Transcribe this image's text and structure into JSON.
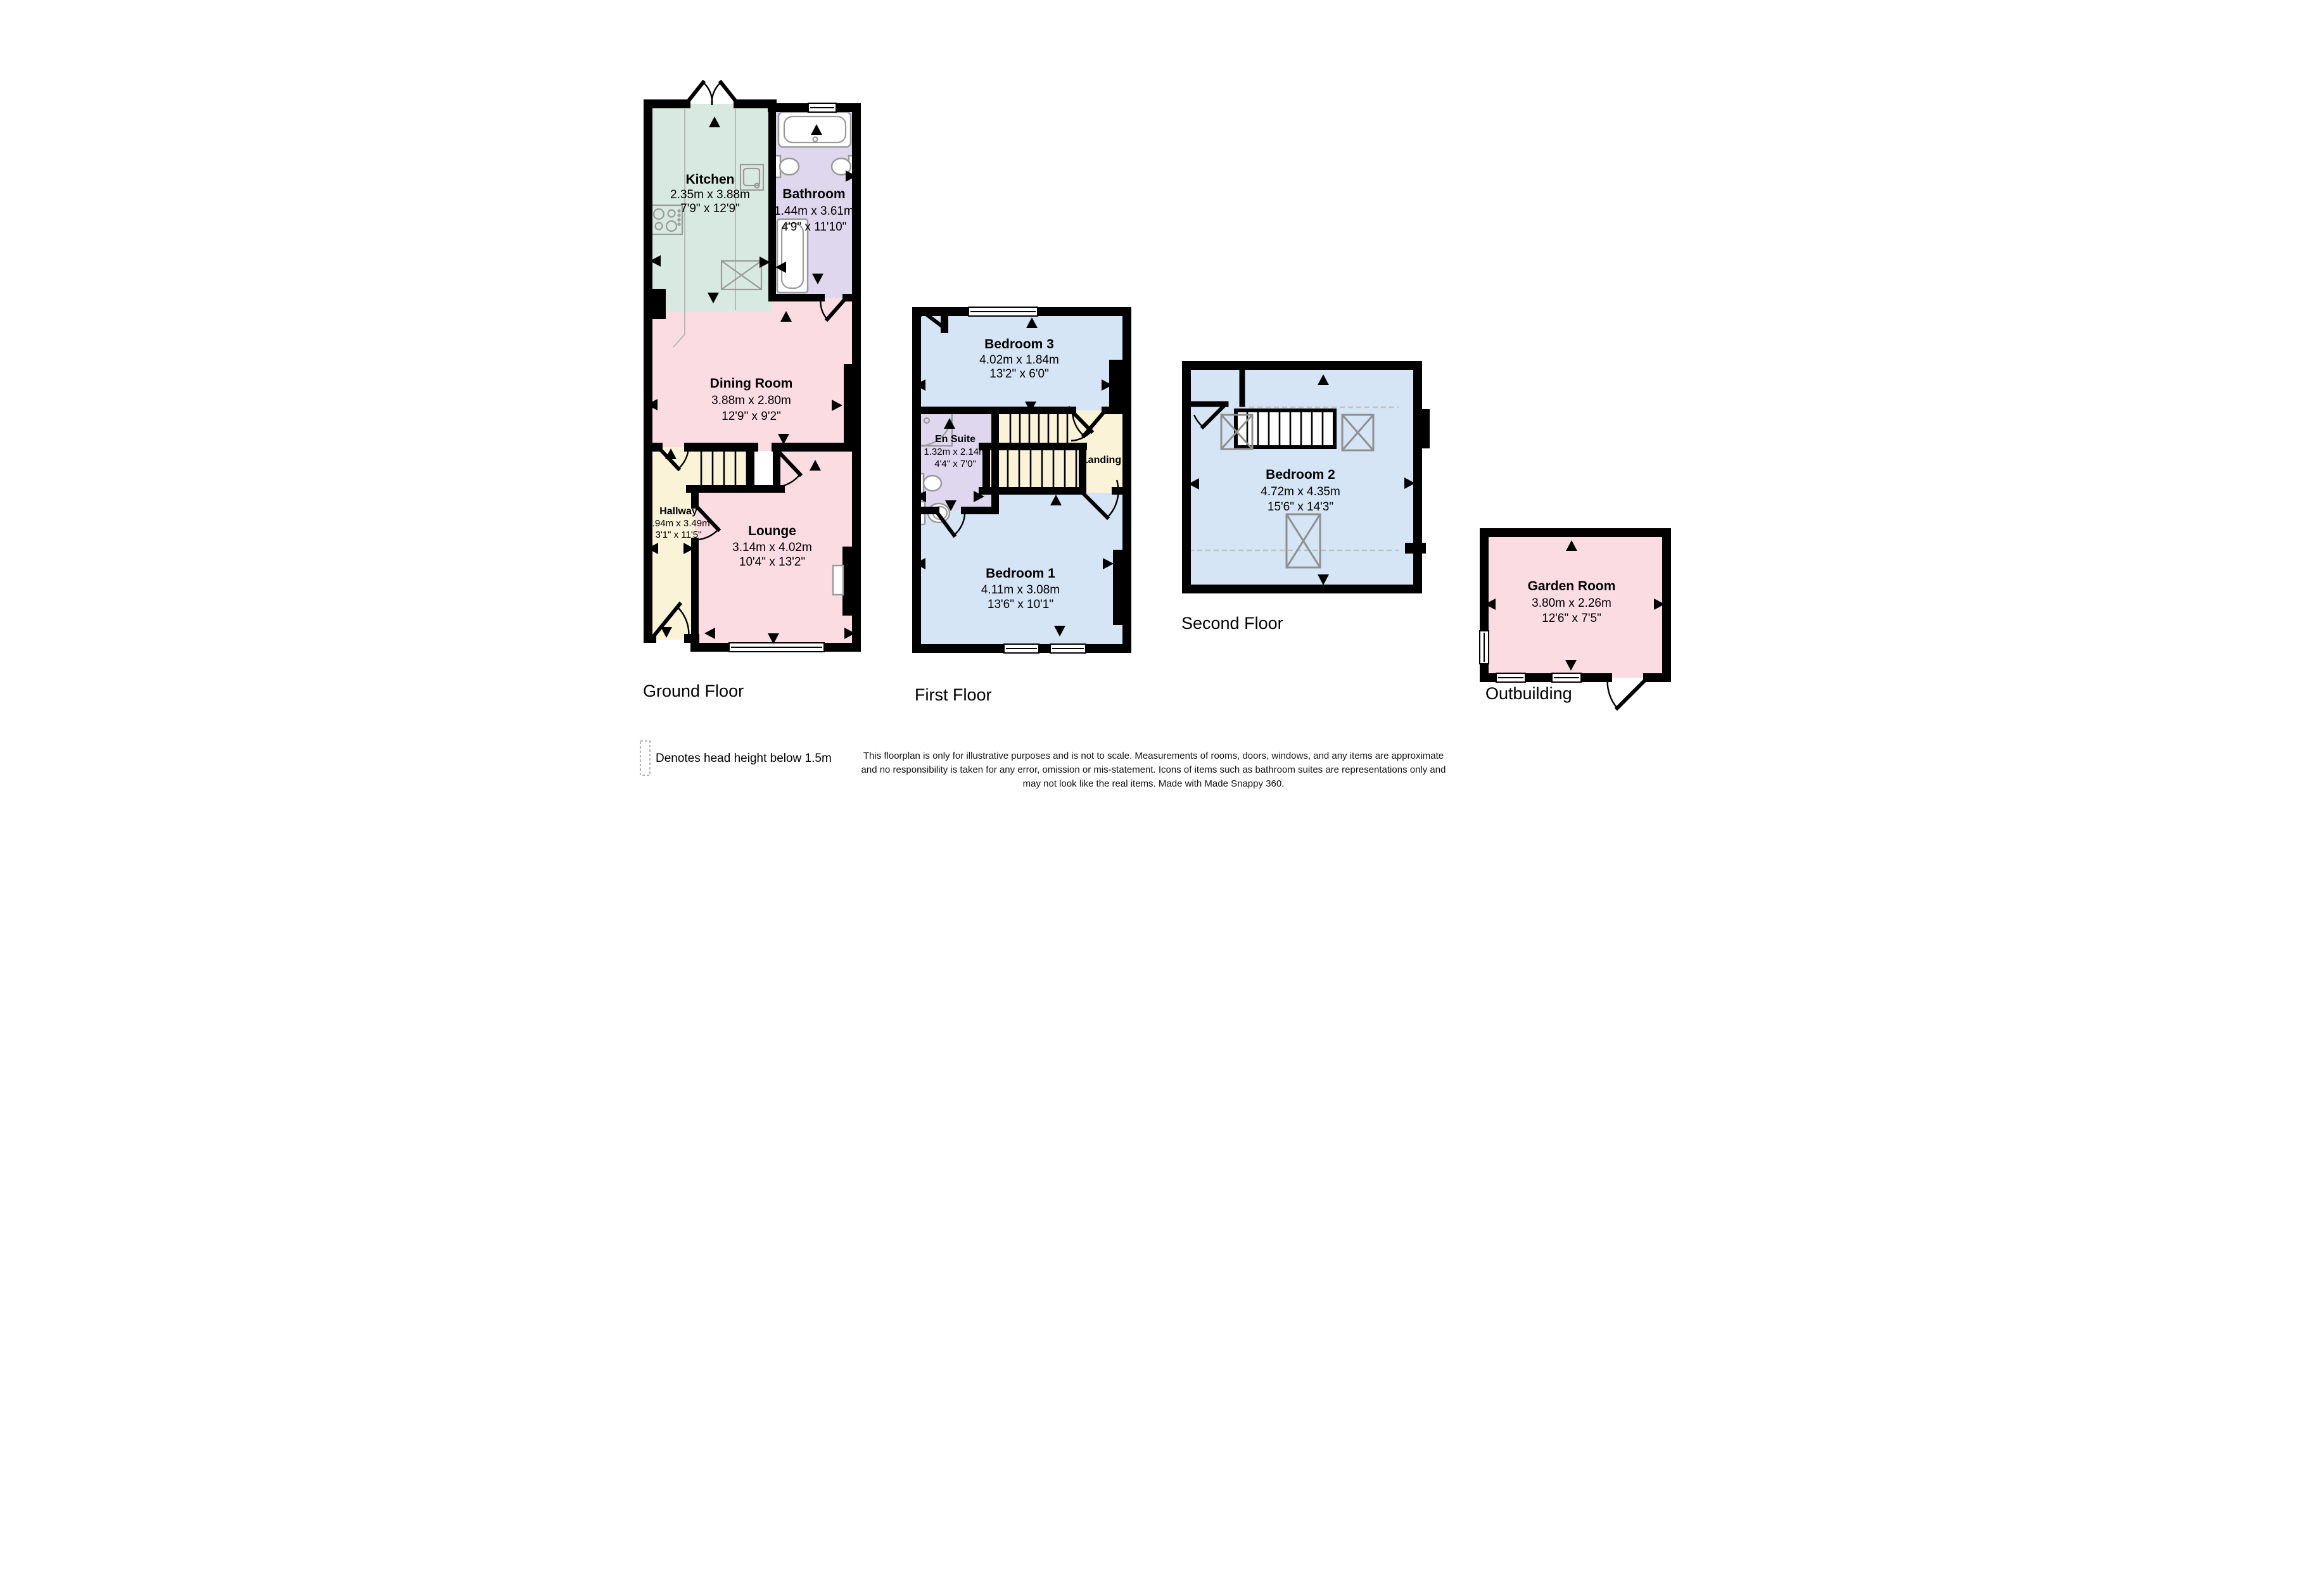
{
  "colors": {
    "wall": "#000000",
    "room_kitchen": "#d8e9e1",
    "room_bath": "#ded7ee",
    "room_pink": "#fbdce2",
    "room_cream": "#fbf3d8",
    "room_blue": "#d5e5f6",
    "fixture_outline": "#9a9a9a",
    "head_height_dash": "#c2c2c2"
  },
  "floors": {
    "ground": {
      "label": "Ground Floor",
      "rooms": {
        "kitchen": {
          "name": "Kitchen",
          "metric": "2.35m x 3.88m",
          "imperial": "7'9\" x 12'9\""
        },
        "bathroom": {
          "name": "Bathroom",
          "metric": "1.44m x 3.61m",
          "imperial": "4'9\" x 11'10\""
        },
        "dining": {
          "name": "Dining Room",
          "metric": "3.88m x 2.80m",
          "imperial": "12'9\" x 9'2\""
        },
        "hallway": {
          "name": "Hallway",
          "metric": "0.94m x 3.49m",
          "imperial": "3'1\" x 11'5\""
        },
        "lounge": {
          "name": "Lounge",
          "metric": "3.14m x 4.02m",
          "imperial": "10'4\" x 13'2\""
        }
      }
    },
    "first": {
      "label": "First Floor",
      "rooms": {
        "bedroom3": {
          "name": "Bedroom 3",
          "metric": "4.02m x 1.84m",
          "imperial": "13'2\" x 6'0\""
        },
        "ensuite": {
          "name": "En Suite",
          "metric": "1.32m x 2.14m",
          "imperial": "4'4\" x 7'0\""
        },
        "landing": {
          "name": "Landing"
        },
        "bedroom1": {
          "name": "Bedroom 1",
          "metric": "4.11m x 3.08m",
          "imperial": "13'6\" x 10'1\""
        }
      }
    },
    "second": {
      "label": "Second Floor",
      "rooms": {
        "bedroom2": {
          "name": "Bedroom 2",
          "metric": "4.72m x 4.35m",
          "imperial": "15'6\" x 14'3\""
        }
      }
    },
    "outbuilding": {
      "label": "Outbuilding",
      "rooms": {
        "garden": {
          "name": "Garden Room",
          "metric": "3.80m x 2.26m",
          "imperial": "12'6\" x 7'5\""
        }
      }
    }
  },
  "legend": {
    "text": "Denotes head height below 1.5m"
  },
  "disclaimer": {
    "line1": "This floorplan is only for illustrative purposes and is not to scale. Measurements of rooms, doors, windows, and any items are approximate",
    "line2": "and no responsibility is taken for any error, omission or mis-statement. Icons of items such as bathroom suites are representations only and",
    "line3": "may not look like the real items. Made with Made Snappy 360."
  }
}
